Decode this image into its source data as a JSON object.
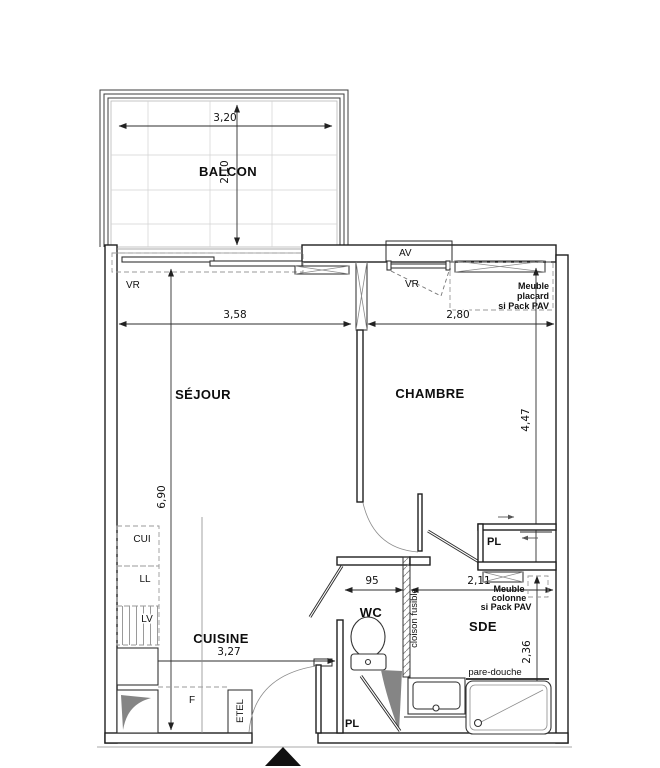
{
  "rooms": {
    "balcon": "BALCON",
    "sejour": "SÉJOUR",
    "chambre": "CHAMBRE",
    "cuisine": "CUISINE",
    "wc": "WC",
    "sde": "SDE"
  },
  "dimensions": {
    "balcon_width": "3,20",
    "balcon_depth": "2,10",
    "sejour_width": "3,58",
    "chambre_width": "2,80",
    "sejour_height": "6,90",
    "chambre_height": "4,47",
    "wc_width": "95",
    "sde_width": "2,11",
    "cuisine_width": "3,27",
    "sde_height": "2,36"
  },
  "equipment_labels": {
    "vr_balcony": "VR",
    "av_window": "AV",
    "vr_window": "VR",
    "kitchen_cui": "CUI",
    "kitchen_ll": "LL",
    "kitchen_lv": "LV",
    "fridge": "F",
    "etel": "ETEL",
    "closet_chambre": "PL",
    "closet_hall": "PL",
    "partition": "cloison fusible",
    "shower_screen": "pare-douche"
  },
  "notes": {
    "meuble_placard": [
      "Meuble",
      "placard",
      "si Pack PAV"
    ],
    "meuble_colonne": [
      "Meuble",
      "colonne",
      "si Pack PAV"
    ]
  },
  "colors": {
    "wall_stroke": "#1f1f1f",
    "dim_stroke": "#2e2e2e",
    "dashed": "#9a9a9a",
    "shade_fill": "#858585",
    "grid": "#d2d2d2",
    "background": "#ffffff"
  }
}
